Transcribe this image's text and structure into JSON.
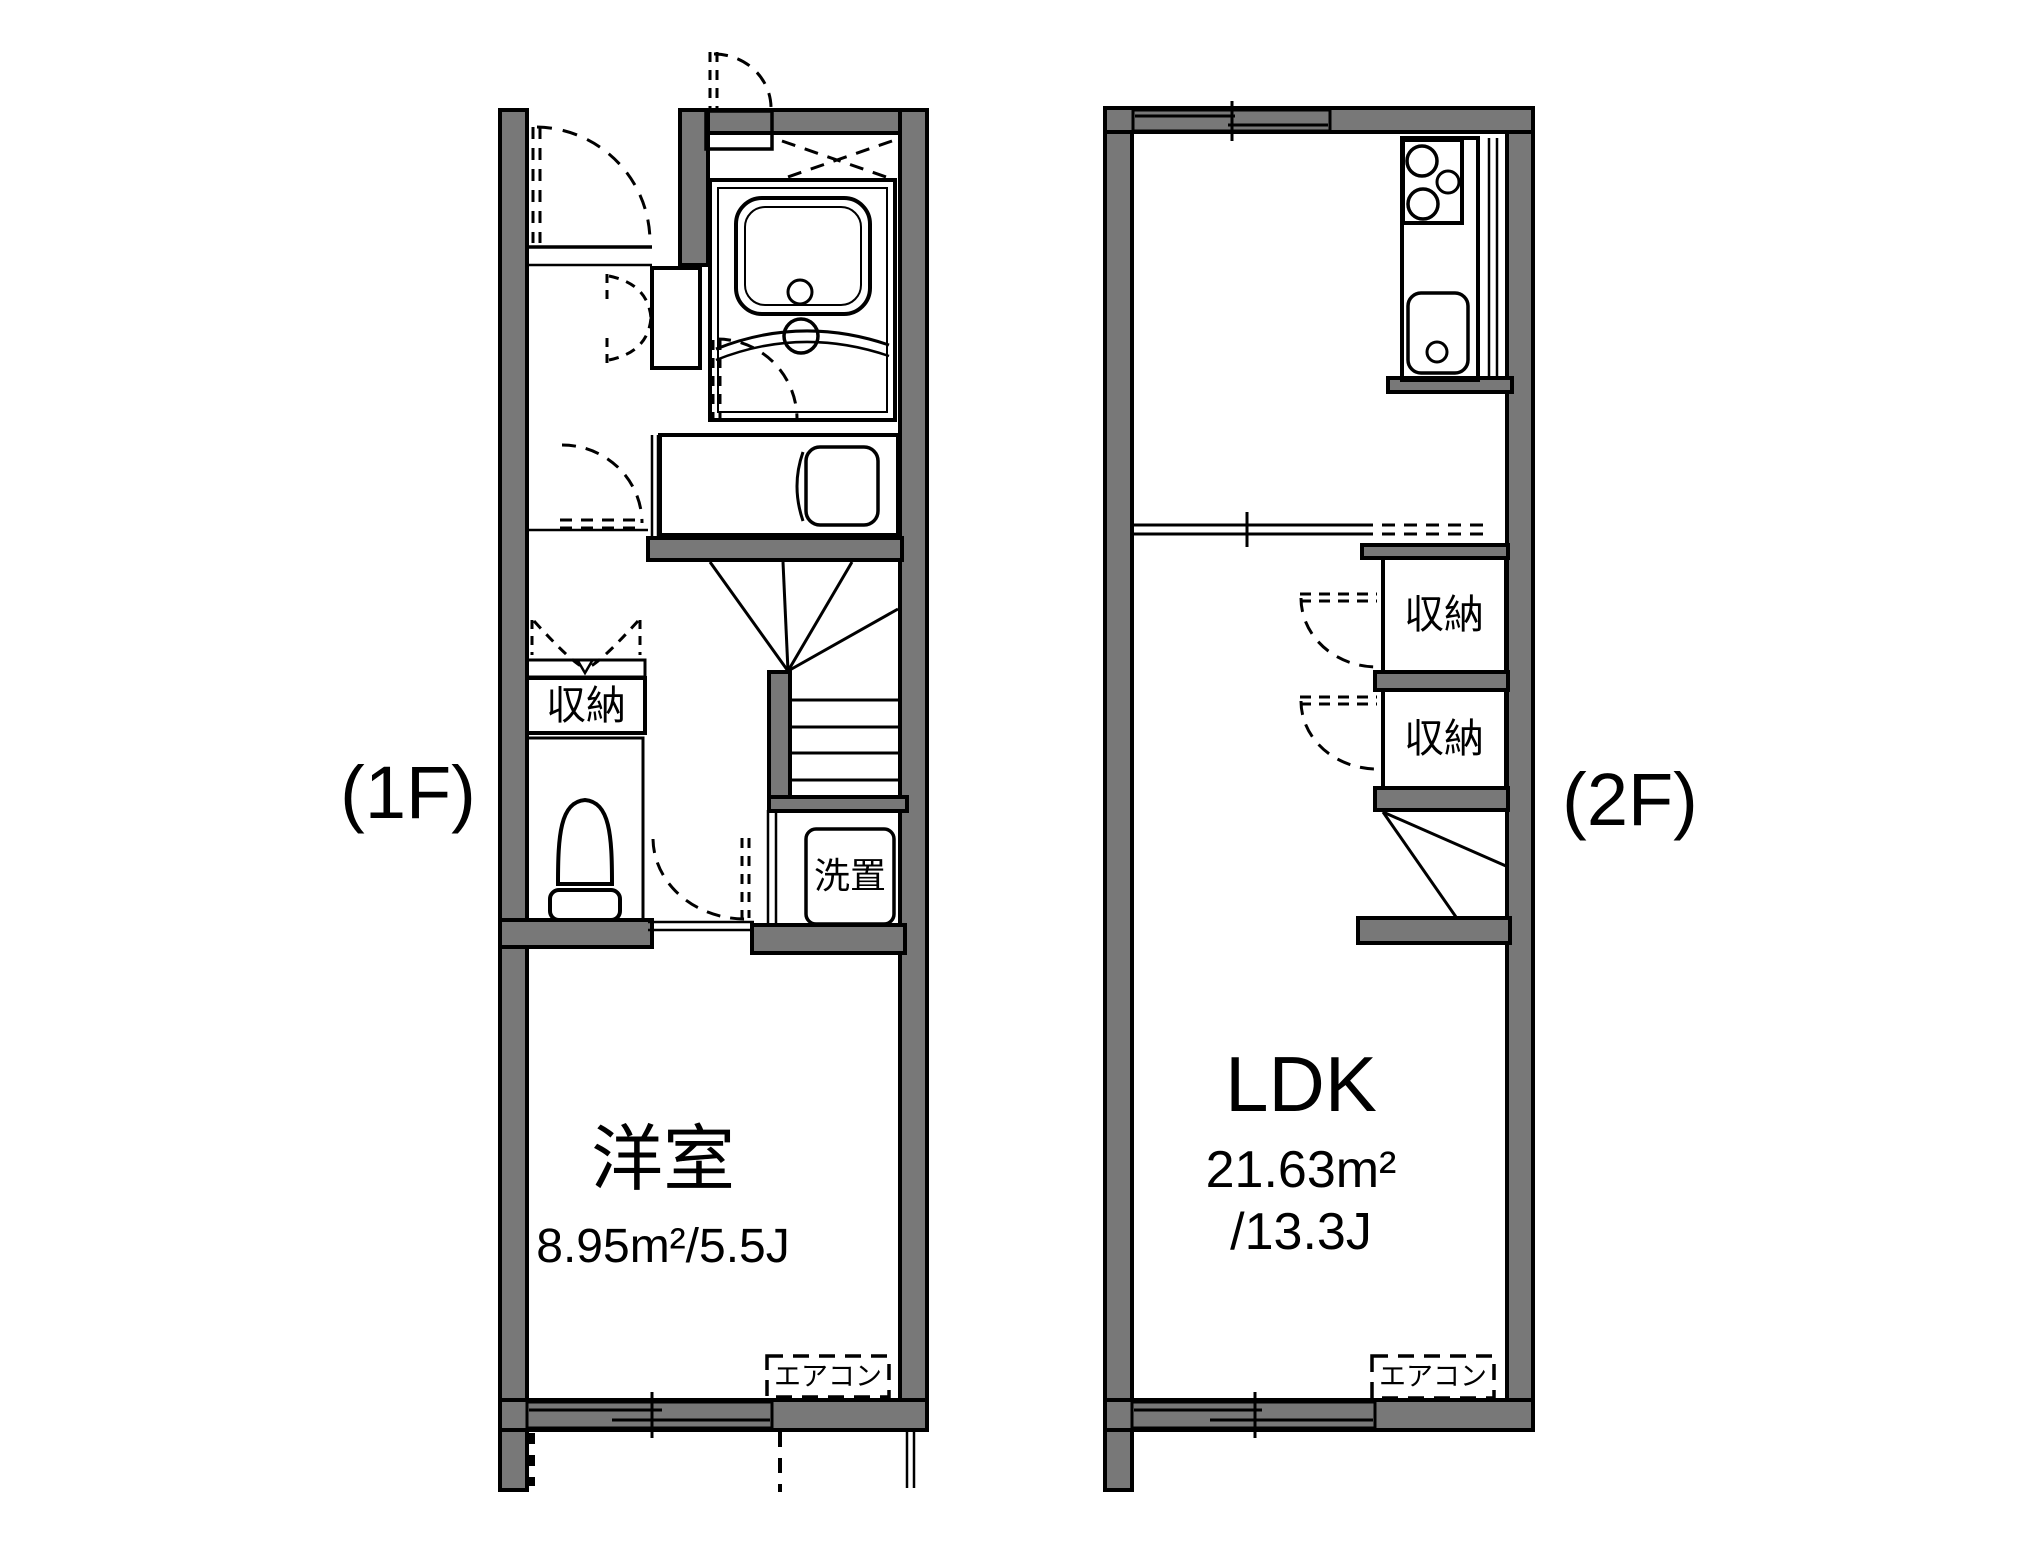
{
  "floors": {
    "f1": {
      "label": "(1F)",
      "room": {
        "name": "洋室",
        "area": "8.95m²/5.5J"
      },
      "storage": "収納",
      "laundry": "洗置",
      "aircon": "エアコン"
    },
    "f2": {
      "label": "(2F)",
      "room": {
        "name": "LDK",
        "area_m2": "21.63m²",
        "area_j": "/13.3J"
      },
      "storage_top": "収納",
      "storage_bottom": "収納",
      "aircon": "エアコン"
    }
  },
  "colors": {
    "wall": "#787878",
    "outline": "#000000",
    "fixture_blue": "#dce7f7",
    "storage_cream": "#fbeed3",
    "background": "#ffffff"
  }
}
